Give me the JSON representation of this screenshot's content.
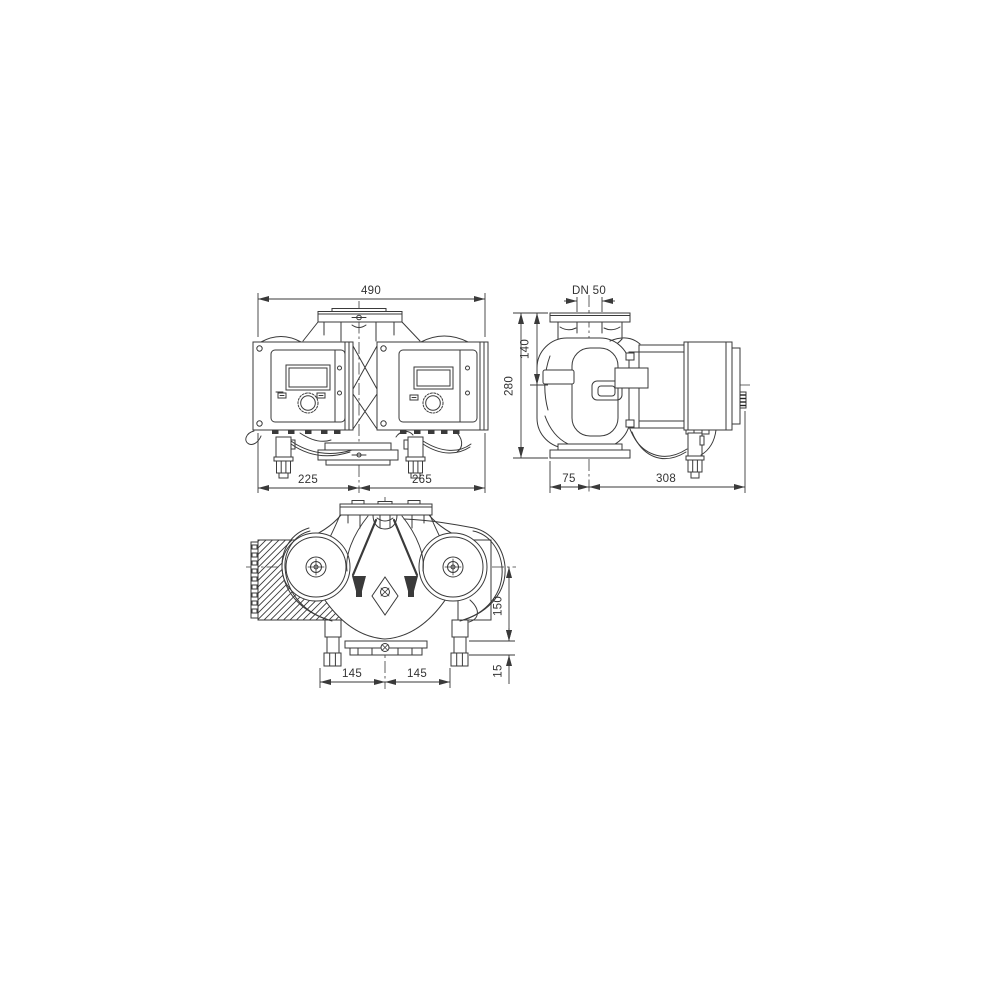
{
  "drawing": {
    "background": "#ffffff",
    "line_color": "#3a3a3a",
    "text_color": "#333333",
    "views": {
      "front": {
        "name": "front-view",
        "dim_width_total": "490",
        "dim_width_left": "225",
        "dim_width_right": "265"
      },
      "side": {
        "name": "side-view",
        "dim_flange_nominal": "DN 50",
        "dim_flange_to_center": "140",
        "dim_height_total": "280",
        "dim_depth_front": "75",
        "dim_depth_back": "308"
      },
      "top": {
        "name": "top-view",
        "dim_center_to_base": "150",
        "dim_base_thickness": "15",
        "dim_pitch_left": "145",
        "dim_pitch_right": "145"
      }
    }
  }
}
